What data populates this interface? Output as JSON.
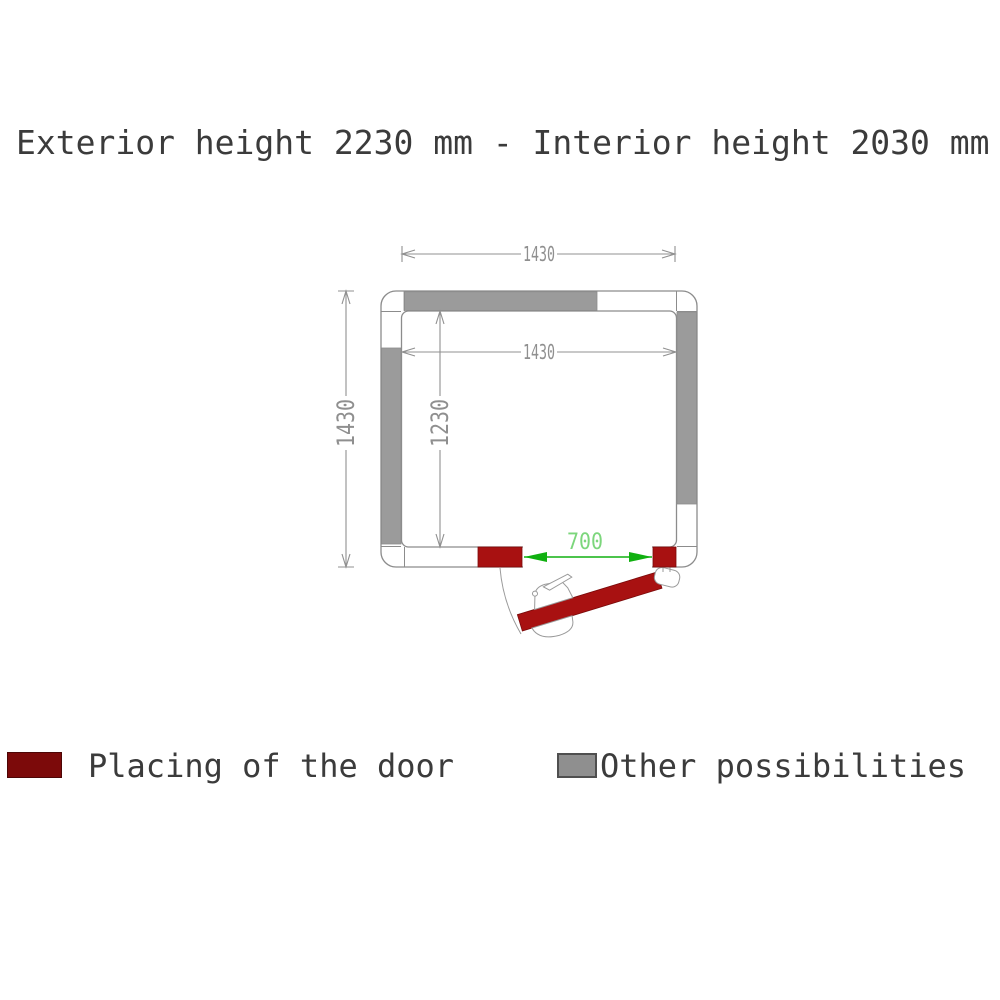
{
  "title": "Exterior height 2230 mm - Interior height 2030 mm",
  "plan": {
    "dim_exterior_width_mm": "1430",
    "dim_interior_width_mm": "1430",
    "dim_exterior_depth_mm": "1430",
    "dim_interior_depth_mm": "1230",
    "dim_door_opening_mm": "700"
  },
  "legend": {
    "door_label": "Placing of the door",
    "other_label": "Other possibilities"
  },
  "colors": {
    "door_red": "#a81111",
    "legend_red": "#7c0a0a",
    "wall_gray": "#9b9b9b",
    "legend_gray": "#8f8f8f",
    "line_gray": "#8c8c8c",
    "dim_text_gray": "#8f8f8f",
    "green_arrow": "#10b010",
    "green_text": "#7cd67c",
    "title_text": "#3b3b3b"
  }
}
